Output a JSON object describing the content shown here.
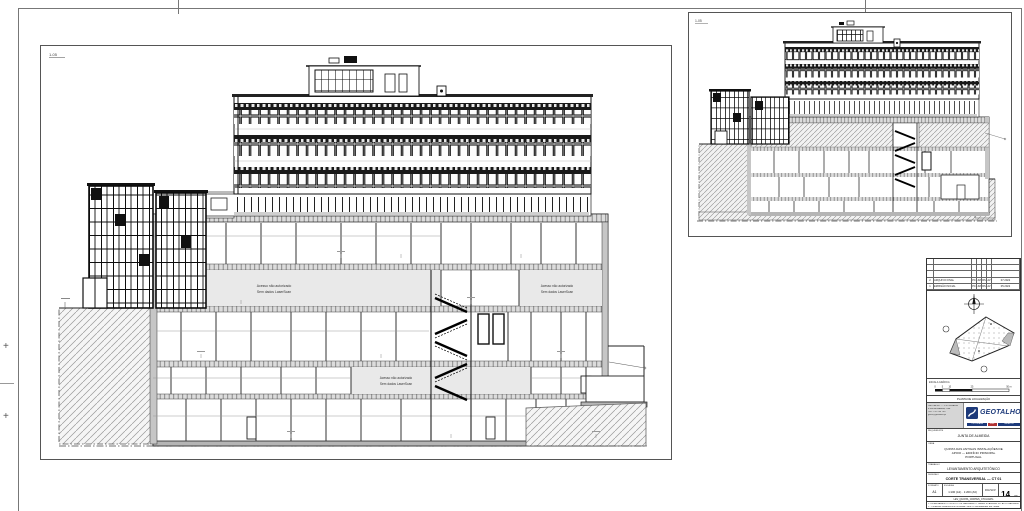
{
  "sheet": {
    "plus_mark": "+",
    "main_view_tag": "1-05",
    "small_view_tag": "1-05"
  },
  "drawing_labels": {
    "no_access_line1": "Acesso não autorizado",
    "no_access_line2": "Sem dados LaserScan"
  },
  "titleblock": {
    "revisions": {
      "rows": [
        {
          "no": "2",
          "desc": "ARQUIVO FINAL",
          "a": "PC",
          "b": "JM",
          "c": "RS",
          "d": "AV",
          "date": "07.2022"
        },
        {
          "no": "1",
          "desc": "EMISSÃO INICIAL",
          "a": "PC",
          "b": "JM",
          "c": "RS",
          "d": "AV",
          "date": "05.2022"
        }
      ],
      "header": {
        "no": "Nº",
        "desc": "DESCRIÇÃO",
        "a": "ELA",
        "b": "DES",
        "c": "VER",
        "d": "APR",
        "date": "DATA"
      }
    },
    "location_plan": {
      "caption": "PLANTA DE LOCALIZAÇÃO"
    },
    "scale_bar": {
      "label": "ESCALA GRÁFICA",
      "t0": "0",
      "t1": "5",
      "t2": "10",
      "t3": "25",
      "t4": "50 m"
    },
    "company": {
      "name": "GEOTALHO",
      "addr1": "GEOTALHO — TOPOGRAFIA",
      "addr2": "E ENGENHARIA, LDA.",
      "addr3": "TEL. 212 230 740",
      "addr4": "geral@geotalho.pt",
      "strip1": "TOPOGRAFIA",
      "strip2": "ENG.",
      "strip3": "CADASTRO"
    },
    "client_label": "REQUERENTE",
    "client": "JUNTA DE ALMEIDA",
    "project_label": "OBRA",
    "project_line1": "QUINTA DAS ANTIGAS INSTALAÇÕES DE",
    "project_line2": "APOIO — EDIFÍCIO PRINCIPAL",
    "project_line3": "PORTUGAL",
    "spec_label": "TRABALHO",
    "spec": "LEVANTAMENTO ARQUITETÓNICO",
    "title_label": "DESENHO",
    "title": "CORTE TRANSVERSAL — CT 01",
    "meta": {
      "format_label": "FORMATO",
      "format": "A1",
      "scale_label": "ESCALAS",
      "scale": "1:100 (A1) · 1:200 (A3)",
      "sheet_label": "FOLHA Nº",
      "sheet_no": "14",
      "sheet_suffix": "DE"
    },
    "file_row": "LEV_QUINTA_CORTES_CT01.DWG",
    "note1": "1. LEVANTAMENTO OBTIDO POR VARRIMENTO LASER SCANNING 3D. AS ZONAS ASSINALADAS NÃO FORAM LEVANTADAS.",
    "note2": "2. TODAS AS DIMENSÕES DEVERÃO SER CONFIRMADAS EM OBRA."
  },
  "colors": {
    "brand_blue": "#1d3a7a",
    "accent_red": "#b03434",
    "zone_grey": "#e9e9e9",
    "slab_grey": "#d9d9d9"
  }
}
